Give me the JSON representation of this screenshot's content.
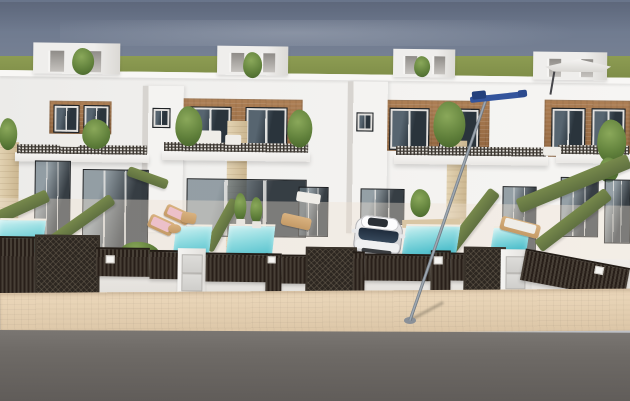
{
  "scene": {
    "kind": "architectural-3d-render",
    "subject": "row of modern white two-storey townhouses with roof terraces, private pools and dark street fences",
    "house_count": 4,
    "pool_count": 5,
    "objects": [
      "roof-terrace-boxes",
      "cantilever-umbrella",
      "wood-clad-upper-floors",
      "balcony-lattice-railings",
      "hedge-topped-dividing-walls",
      "plunge-pools",
      "sun-loungers",
      "potted-plants",
      "white-suv-car",
      "slatted-fences-and-mesh-gates",
      "utility-meter-pillars",
      "street-lamp-with-blue-arm",
      "beige-sidewalk",
      "asphalt-road"
    ]
  },
  "palette": {
    "sky_top": "#69758b",
    "sky_mid": "#8e96a4",
    "sky_low": "#bcbfc4",
    "grass": "#8d9c52",
    "grass_dark": "#7c8b47",
    "wood": "#ad7f55",
    "wood_dark": "#91653e",
    "hedge": "#77894c",
    "hedge_dark": "#5f7040",
    "pool": "#56c2ce",
    "pool_deep": "#3fafc0",
    "pool_light": "#cdf1f2",
    "walk": "#ecd8bb",
    "walk_dark": "#dcc6a7",
    "road": "#6e6a66",
    "road_dark": "#5f5b58",
    "wood_tan": "#c49a66",
    "lounger_pink": "#ecc0c9",
    "lamp_blue": "#33549c"
  }
}
